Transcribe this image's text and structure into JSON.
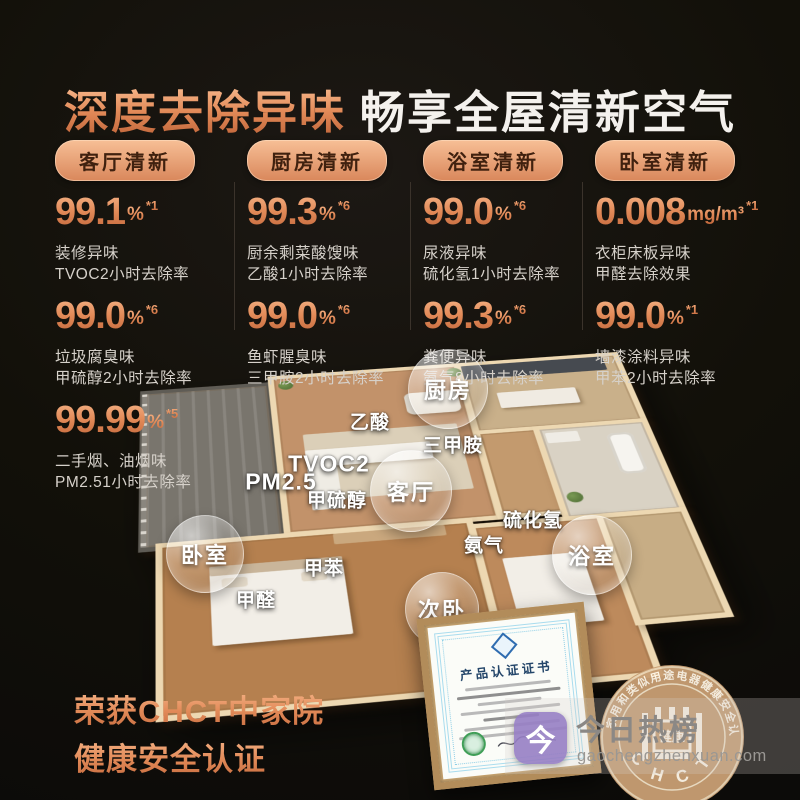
{
  "header": {
    "title_accent": "深度去除异味",
    "title_main": "畅享全屋清新空气"
  },
  "stats_columns": [
    {
      "badge": "客厅清新",
      "stats": [
        {
          "value": "99.1",
          "unit": "%",
          "note": "*1",
          "line1": "装修异味",
          "line2": "TVOC2小时去除率"
        },
        {
          "value": "99.0",
          "unit": "%",
          "note": "*6",
          "line1": "垃圾腐臭味",
          "line2": "甲硫醇2小时去除率"
        },
        {
          "value": "99.99",
          "unit": "%",
          "note": "*5",
          "line1": "二手烟、油烟味",
          "line2": "PM2.51小时去除率"
        }
      ]
    },
    {
      "badge": "厨房清新",
      "stats": [
        {
          "value": "99.3",
          "unit": "%",
          "note": "*6",
          "line1": "厨余剩菜酸馊味",
          "line2": "乙酸1小时去除率"
        },
        {
          "value": "99.0",
          "unit": "%",
          "note": "*6",
          "line1": "鱼虾腥臭味",
          "line2": "三甲胺2小时去除率"
        }
      ]
    },
    {
      "badge": "浴室清新",
      "stats": [
        {
          "value": "99.0",
          "unit": "%",
          "note": "*6",
          "line1": "尿液异味",
          "line2": "硫化氢1小时去除率"
        },
        {
          "value": "99.3",
          "unit": "%",
          "note": "*6",
          "line1": "粪便异味",
          "line2": "氨气8小时去除率"
        }
      ]
    },
    {
      "badge": "卧室清新",
      "stats": [
        {
          "value": "0.008",
          "unit": "mg/m³",
          "note": "*1",
          "line1": "衣柜床板异味",
          "line2": "甲醛去除效果"
        },
        {
          "value": "99.0",
          "unit": "%",
          "note": "*1",
          "line1": "墙漆涂料异味",
          "line2": "甲苯2小时去除率"
        }
      ]
    }
  ],
  "floorplan": {
    "room_labels": [
      {
        "key": "kitchen",
        "label": "厨房",
        "x": 447,
        "y": 388,
        "size": 78
      },
      {
        "key": "living-room",
        "label": "客厅",
        "x": 410,
        "y": 490,
        "size": 80
      },
      {
        "key": "bedroom",
        "label": "卧室",
        "x": 204,
        "y": 553,
        "size": 76
      },
      {
        "key": "bathroom",
        "label": "浴室",
        "x": 591,
        "y": 554,
        "size": 78
      },
      {
        "key": "second-bedroom",
        "label": "次卧",
        "x": 441,
        "y": 608,
        "size": 72
      }
    ],
    "chemical_labels": [
      {
        "label": "乙酸",
        "x": 370,
        "y": 421,
        "big": false
      },
      {
        "label": "三甲胺",
        "x": 453,
        "y": 444,
        "big": false
      },
      {
        "label": "TVOC2",
        "x": 329,
        "y": 464,
        "big": true
      },
      {
        "label": "PM2.5",
        "x": 281,
        "y": 482,
        "big": true
      },
      {
        "label": "甲硫醇",
        "x": 337,
        "y": 499,
        "big": false
      },
      {
        "label": "硫化氢",
        "x": 533,
        "y": 519,
        "big": false
      },
      {
        "label": "氨气",
        "x": 484,
        "y": 544,
        "big": false
      },
      {
        "label": "甲苯",
        "x": 324,
        "y": 567,
        "big": false
      },
      {
        "label": "甲醛",
        "x": 256,
        "y": 599,
        "big": false
      }
    ]
  },
  "award": {
    "line1": "荣获CHCT中家院",
    "line2": "健康安全认证"
  },
  "certificate": {
    "title": "产品认证证书"
  },
  "seal": {
    "ring_text": "家用和类似用途电器健康安全认证",
    "center_text": "健康",
    "bottom_text": "C H C T"
  },
  "watermark": {
    "brand": "今日热榜",
    "domain": "gaochengzhenxuan.com",
    "logo_glyph": "今"
  },
  "colors": {
    "accent": "#e79a68",
    "accent_dark": "#c0653a",
    "background": "#0f0d0b",
    "badge_text": "#40210f",
    "watermark_purple": "#947cc4"
  }
}
